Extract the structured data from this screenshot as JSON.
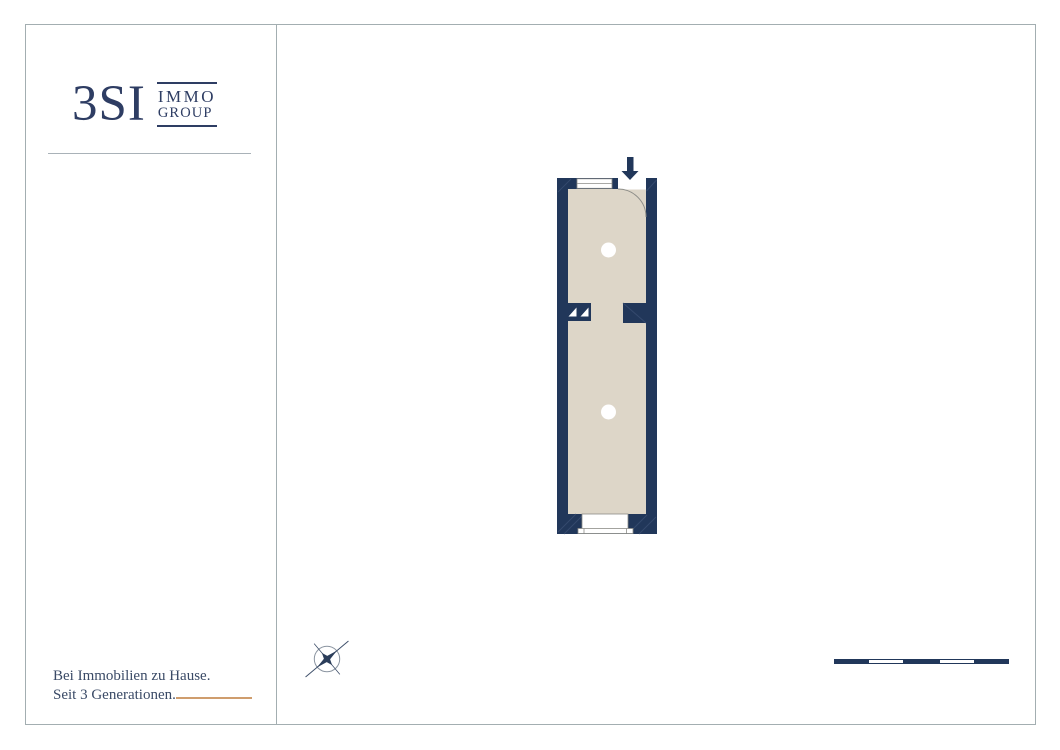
{
  "brand": {
    "logo_main": "3SI",
    "logo_sub_line1": "IMMO",
    "logo_sub_line2": "GROUP"
  },
  "footer": {
    "tagline_line1": "Bei Immobilien zu Hause.",
    "tagline_line2": "Seit 3 Generationen."
  },
  "plan": {
    "type": "floor-plan",
    "rooms": 2,
    "elements": [
      "entrance-arrow",
      "door-swing-arc",
      "window-top",
      "window-bottom-with-sill",
      "niche-triangles",
      "shaft-block",
      "ceiling-light-upper",
      "ceiling-light-lower"
    ],
    "colors": {
      "wall_navy": "#21375a",
      "floor_beige": "#ddd6c8",
      "accent_copper": "#cf9d6d",
      "thin_line_gray": "#8d8d88"
    }
  },
  "compass": {
    "icon": "compass-rose"
  },
  "scalebar": {
    "segments": 5,
    "pattern": [
      "navy",
      "white",
      "navy",
      "white",
      "navy"
    ]
  }
}
